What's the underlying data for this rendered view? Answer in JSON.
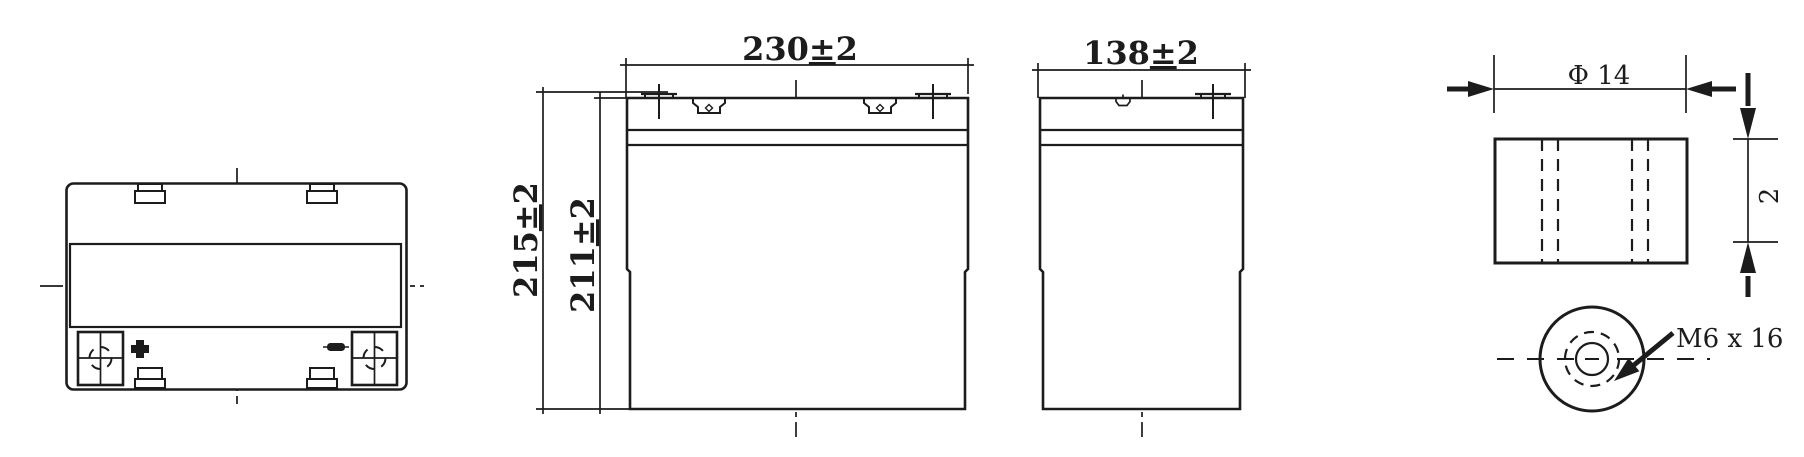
{
  "colors": {
    "line": "#1c1c1c",
    "background": "#ffffff"
  },
  "dimensions": {
    "width": {
      "value": "230",
      "pm": "±",
      "tol": "2"
    },
    "overall_height": {
      "value": "215",
      "pm": "±",
      "tol": "2"
    },
    "container_height": {
      "value": "211",
      "pm": "±",
      "tol": "2"
    },
    "depth": {
      "value": "138",
      "pm": "±",
      "tol": "2"
    },
    "terminal_diameter": {
      "value": "Φ 14"
    },
    "terminal_thickness": {
      "value": "2"
    },
    "terminal_thread": {
      "value": "M6 x 16"
    }
  }
}
